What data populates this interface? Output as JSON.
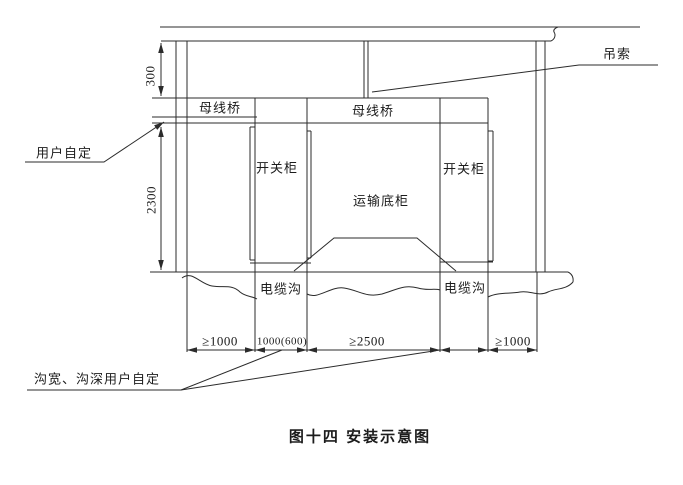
{
  "figure": {
    "caption": "图十四 安装示意图"
  },
  "labels": {
    "sling": "吊索",
    "busbar_bridge_left": "母线桥",
    "busbar_bridge_right": "母线桥",
    "switch_cabinet_left": "开关柜",
    "switch_cabinet_right": "开关柜",
    "transport_base_cabinet": "运输底柜",
    "cable_trench_left": "电缆沟",
    "cable_trench_right": "电缆沟",
    "user_defined_gap": "用户自定",
    "trench_note": "沟宽、沟深用户自定"
  },
  "dimensions": {
    "ceiling_to_busbar": "300",
    "cabinet_height": "2300",
    "left_clearance": "≥1000",
    "left_trench_width": "1000(600)",
    "center_clearance": "≥2500",
    "right_clearance": "≥1000"
  },
  "colors": {
    "line": "#2b2b2b",
    "background": "#ffffff",
    "text": "#1c1c1c"
  }
}
